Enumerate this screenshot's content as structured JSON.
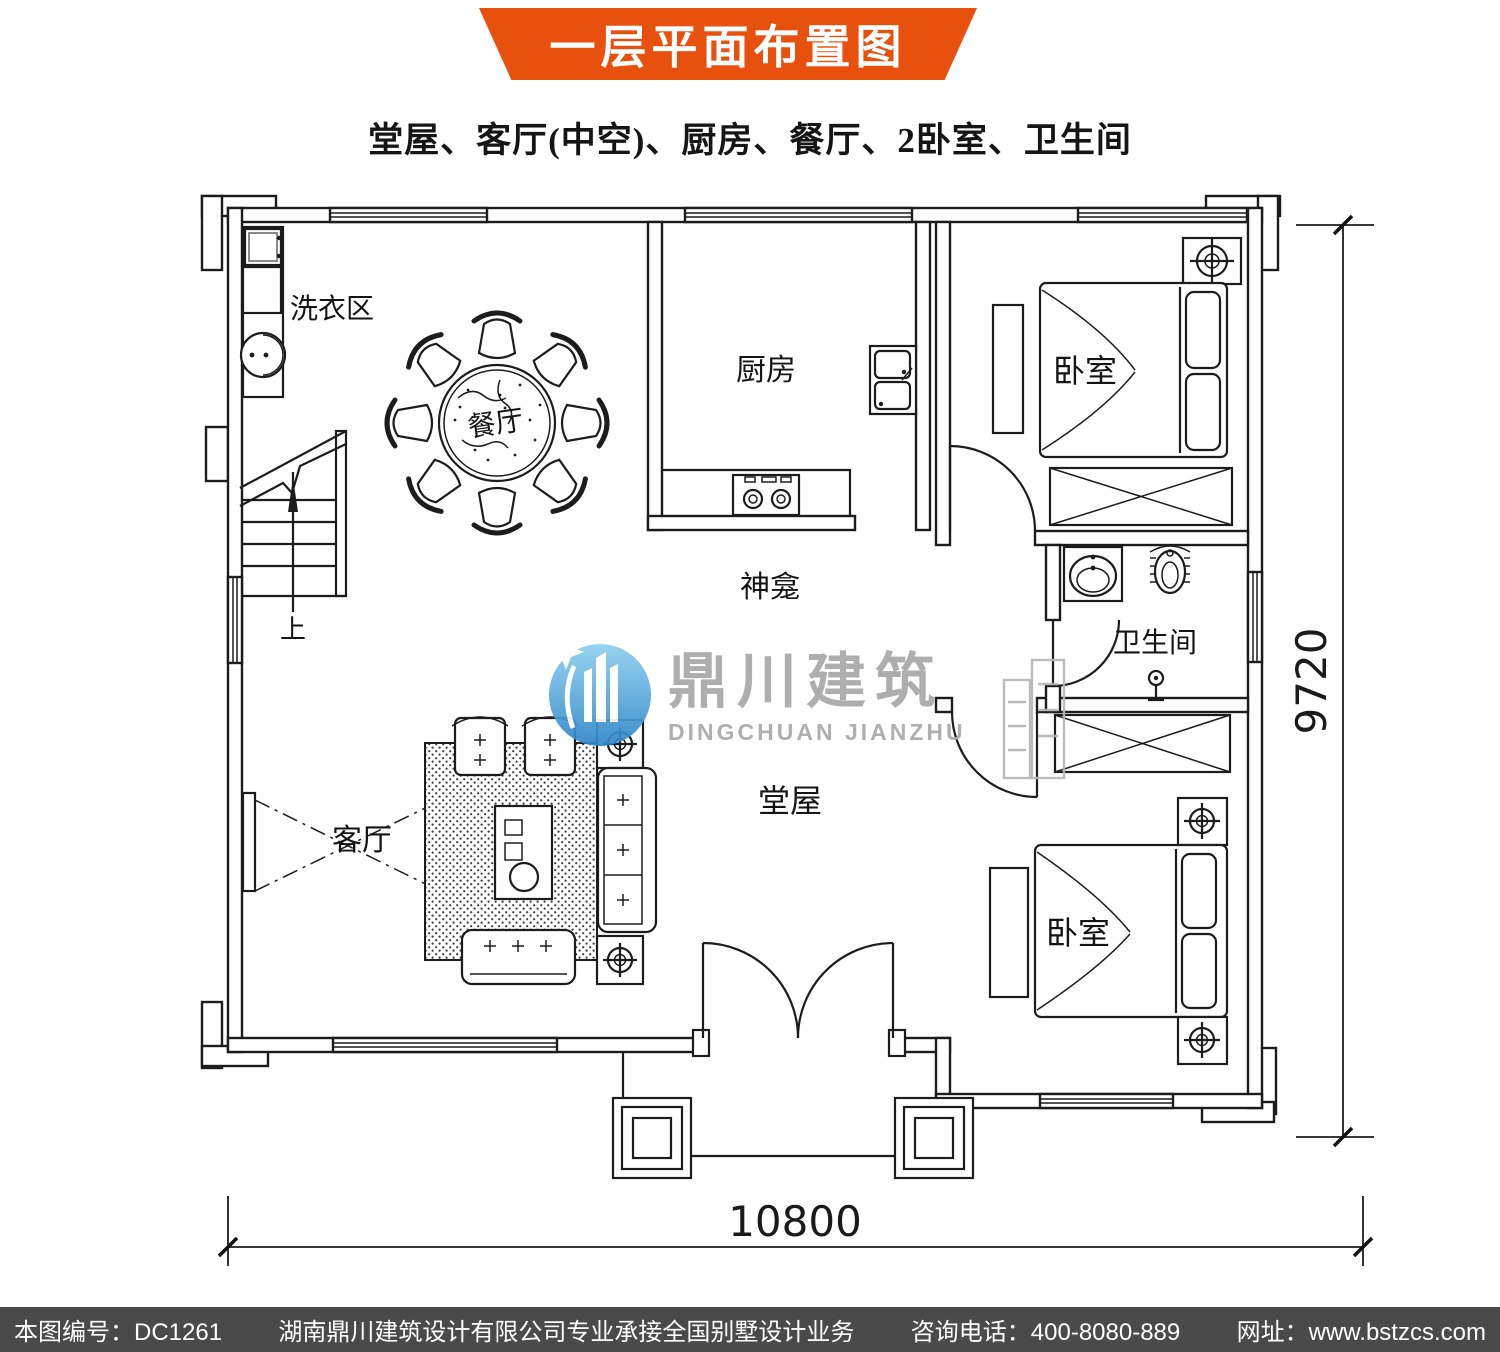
{
  "header": {
    "title": "一层平面布置图",
    "subtitle": "堂屋、客厅(中空)、厨房、餐厅、2卧室、卫生间"
  },
  "colors": {
    "banner_orange": "#e8500e",
    "footer_bg": "#4a4a4a",
    "logo_blue": "#3f93cf",
    "watermark_gray": "#a8a8a8",
    "line_black": "#1c1c1c"
  },
  "plan": {
    "rooms": {
      "laundry": "洗衣区",
      "dining": "餐厅",
      "kitchen": "厨房",
      "shrine": "神龛",
      "bedroom_top": "卧室",
      "bathroom": "卫生间",
      "hall": "堂屋",
      "living": "客厅",
      "bedroom_bottom": "卧室"
    },
    "stairs": {
      "up_label": "上"
    },
    "dimensions": {
      "width_mm": "10800",
      "height_mm": "9720"
    }
  },
  "watermark": {
    "name_cn": "鼎川建筑",
    "name_en": "DINGCHUAN JIANZHU"
  },
  "footer": {
    "items": [
      "本图编号：DC1261",
      "湖南鼎川建筑设计有限公司专业承接全国别墅设计业务",
      "咨询电话：400-8080-889",
      "网址：www.bstzcs.com"
    ]
  }
}
